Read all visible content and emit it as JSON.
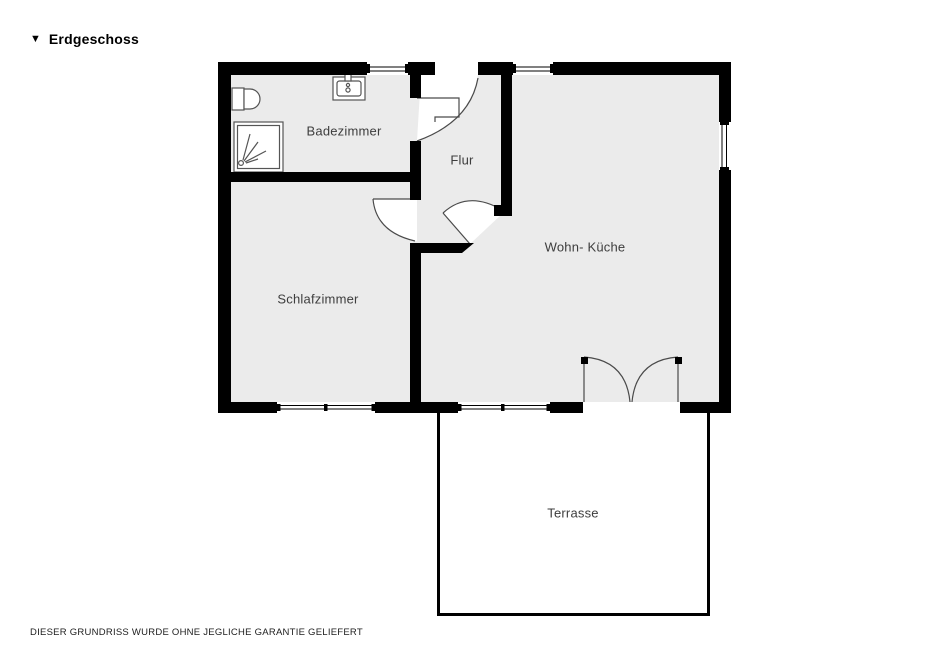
{
  "title": {
    "label": "Erdgeschoss",
    "collapse_marker": "▼"
  },
  "rooms": [
    {
      "id": "badezimmer",
      "label": "Badezimmer"
    },
    {
      "id": "flur",
      "label": "Flur"
    },
    {
      "id": "wohn-kueche",
      "label": "Wohn- Küche"
    },
    {
      "id": "schlafzimmer",
      "label": "Schlafzimmer"
    },
    {
      "id": "terrasse",
      "label": "Terrasse"
    }
  ],
  "fixtures": [
    "toilet",
    "shower",
    "sink"
  ],
  "doors": [
    "entry-door",
    "bathroom-door",
    "bedroom-door",
    "kitchen-door",
    "terrace-double-door"
  ],
  "windows": [
    "bath-top-window",
    "kitchen-top-window",
    "kitchen-right-window",
    "bedroom-bottom-window",
    "kitchen-bottom-window"
  ],
  "colors": {
    "wall": "#000000",
    "room_fill": "#ebebeb",
    "swing_fill": "#ffffff",
    "line": "#4a4a4a",
    "label": "#3d3d3d"
  },
  "footer": {
    "disclaimer": "DIESER GRUNDRISS WURDE OHNE JEGLICHE GARANTIE GELIEFERT"
  }
}
